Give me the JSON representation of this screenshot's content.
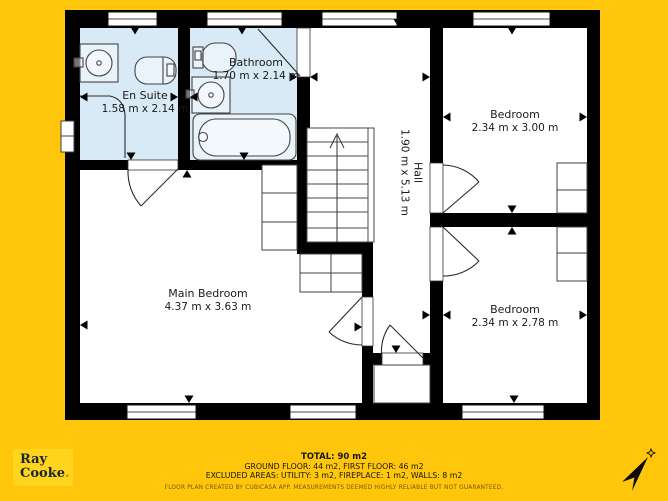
{
  "rooms": {
    "en_suite": {
      "name": "En Suite",
      "dims": "1.58 m x 2.14 m"
    },
    "bathroom": {
      "name": "Bathroom",
      "dims": "1.70 m x 2.14 m"
    },
    "hall": {
      "name": "Hall",
      "dims": "1.90 m x 5.13 m"
    },
    "bedroom_top": {
      "name": "Bedroom",
      "dims": "2.34 m x 3.00 m"
    },
    "bedroom_bottom": {
      "name": "Bedroom",
      "dims": "2.34 m x 2.78 m"
    },
    "main_bedroom": {
      "name": "Main Bedroom",
      "dims": "4.37 m x 3.63 m"
    }
  },
  "footer": {
    "total": "TOTAL: 90 m2",
    "floors": "GROUND FLOOR: 44 m2, FIRST FLOOR: 46 m2",
    "excluded": "EXCLUDED AREAS: UTILITY: 3 m2, FIREPLACE: 1 m2, WALLS: 8 m2",
    "disclaimer": "FLOOR PLAN CREATED BY CUBICASA APP. MEASUREMENTS DEEMED HIGHLY RELIABLE BUT NOT GUARANTEED."
  },
  "logo": {
    "line1": "Ray",
    "line2": "Cooke",
    "dot": "."
  },
  "colors": {
    "background": "#FFC60B",
    "wet_room": "#D8EAF6",
    "wall": "#000000",
    "logo_bg": "#FFD41C",
    "logo_text": "#1C2533",
    "logo_dot": "#E87411"
  }
}
